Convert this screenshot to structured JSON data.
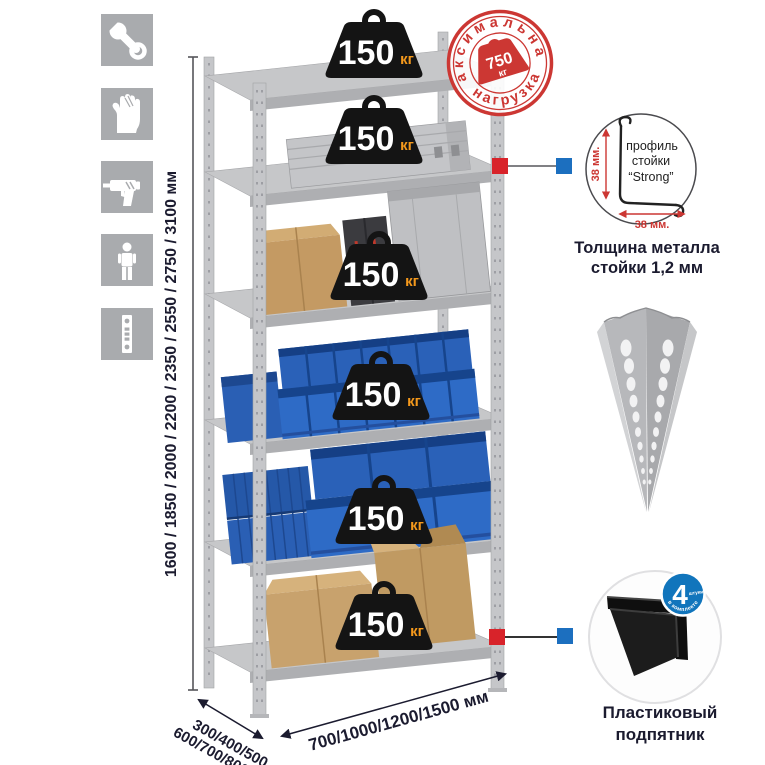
{
  "colors": {
    "accent_red": "#d8232a",
    "accent_blue": "#1c6fbf",
    "stamp_red": "#cc3733",
    "weight_black": "#141414",
    "unit_orange": "#f4991c",
    "metal_light": "#c9cacc",
    "bin_blue": "#2e6bc6",
    "cardboard": "#c8a26d",
    "icon_gray": "#a9abae",
    "text_dark": "#1b1b2f"
  },
  "sidebar": {
    "icons": [
      {
        "name": "wrench"
      },
      {
        "name": "gloves"
      },
      {
        "name": "drill"
      },
      {
        "name": "person"
      },
      {
        "name": "perforated-upright"
      }
    ]
  },
  "dimensions": {
    "height_label": "1600 / 1850 / 2000 / 2200 / 2350 / 2550 / 2750 / 3100 мм",
    "depth_label_line1": "300/400/500",
    "depth_label_line2": "600/700/800 мм",
    "width_label": "700/1000/1200/1500 мм"
  },
  "shelves": {
    "count": 6,
    "weight_value": "150",
    "weight_unit": "кг"
  },
  "max_load_stamp": {
    "arc_top": "максимальная",
    "arc_bottom": "нагрузка",
    "value": "750",
    "unit": "кг"
  },
  "profile_detail": {
    "label_line1": "профиль",
    "label_line2": "стойки",
    "label_line3": "“Strong”",
    "vertical_dim": "38 мм.",
    "horizontal_dim": "38 мм.",
    "caption_line1": "Толщина металла",
    "caption_line2": "стойки 1,2 мм"
  },
  "foot_detail": {
    "badge_number": "4",
    "badge_subtext": "штуки",
    "badge_arc": "в комплекте",
    "caption_line1": "Пластиковый",
    "caption_line2": "подпятник"
  }
}
